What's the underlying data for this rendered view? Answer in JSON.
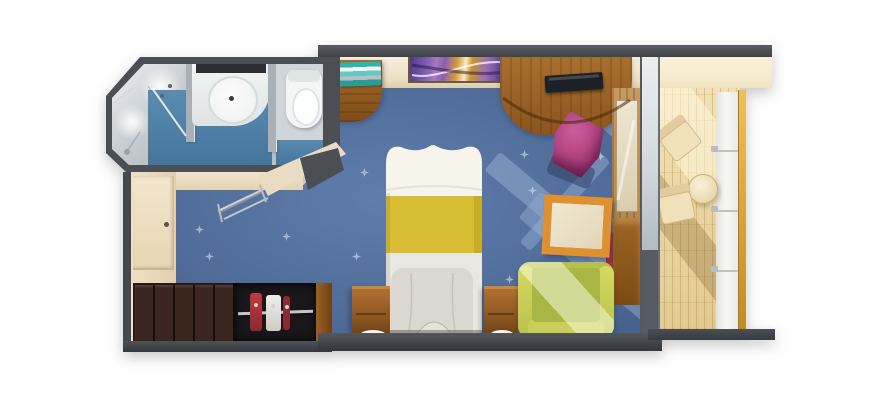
{
  "figure": {
    "type": "floorplan",
    "title": "Cruise ship balcony stateroom — top-down 3D rendered floor plan",
    "background_color": "#ffffff",
    "visible_text": []
  },
  "palette": {
    "walls": "#45494e",
    "carpet_blue": "#54719e",
    "carpet_sparkle": "#d6e1f2",
    "light_streak_blue": "#8fa9c9",
    "wall_face_beige": "#ecdfc6",
    "bathroom_floor_blue": "#4f81a9",
    "bathroom_tile_gray": "#c6ccd0",
    "fixture_white": "#f4f6f5",
    "wood_medium": "#9c6128",
    "wardrobe_dark_brown": "#3b261e",
    "bed_linen_white": "#f6f3ec",
    "bed_blanket_yellow": "#d9bd35",
    "sofa_green": "#bcc452",
    "ottoman_magenta": "#b3437f",
    "table_frame_orange": "#e0902f",
    "balcony_deck_tan": "#ecd8a4",
    "railing_white": "#f3f3f0",
    "railing_trim_gold": "#d8a33c",
    "glass_gray": "#cfd6da",
    "artwork_purple": "#7d5cb2",
    "artwork_gold": "#d99b3a"
  },
  "rooms": [
    {
      "name": "bathroom",
      "floor": "blue and gray tile",
      "features": [
        "shower",
        "vanity sink",
        "toilet",
        "glass partitions"
      ]
    },
    {
      "name": "entry corridor",
      "floor": "blue star-pattern carpet with beige entry",
      "features": [
        "entry door",
        "wardrobe",
        "open closet with hanging clothes",
        "folding luggage rack"
      ]
    },
    {
      "name": "bedroom",
      "floor": "blue star-pattern carpet",
      "features": [
        "bed",
        "two nightstands",
        "curved desk vanity with TV",
        "wall artwork",
        "book shelf",
        "magenta ottoman",
        "orange-framed coffee table",
        "green sofa",
        "mirrored closet strip"
      ]
    },
    {
      "name": "balcony",
      "floor": "teak wood planks",
      "features": [
        "two deck chairs",
        "round side table",
        "white glass railing with gold handrail",
        "sliding glass door"
      ]
    }
  ],
  "items": {
    "bed": {
      "name": "bed with yellow runner",
      "colors": [
        "#f6f3ec",
        "#d9bd35"
      ],
      "bbox": [
        381,
        138,
        106,
        202
      ]
    },
    "sofa": {
      "name": "green sofa",
      "colors": [
        "#bcc452"
      ],
      "bbox": [
        518,
        262,
        96,
        76
      ]
    },
    "ottoman": {
      "name": "magenta ottoman",
      "colors": [
        "#b3437f"
      ],
      "bbox": [
        552,
        116,
        50,
        58
      ]
    },
    "coffee_table": {
      "name": "orange-framed coffee table",
      "colors": [
        "#e0902f",
        "#ece1c8"
      ],
      "bbox": [
        543,
        196,
        68,
        60
      ]
    },
    "desk": {
      "name": "curved wood desk vanity",
      "colors": [
        "#9c6128"
      ],
      "bbox": [
        500,
        57,
        132,
        78
      ]
    },
    "tv": {
      "name": "tv on desk",
      "colors": [
        "#1d2127"
      ],
      "bbox": [
        545,
        74,
        58,
        17
      ]
    },
    "artwork": {
      "name": "abstract wall artwork",
      "colors": [
        "#7d5cb2",
        "#d99b3a"
      ],
      "bbox": [
        408,
        53,
        106,
        30
      ]
    },
    "shelf": {
      "name": "corner shelf with books",
      "colors": [
        "#9c6128",
        "#2fb3ae"
      ],
      "bbox": [
        336,
        60,
        46,
        62
      ]
    },
    "nightstand_left": {
      "name": "left nightstand",
      "bbox": [
        352,
        286,
        38,
        52
      ]
    },
    "nightstand_right": {
      "name": "right nightstand",
      "bbox": [
        484,
        286,
        34,
        52
      ]
    },
    "wardrobe": {
      "name": "dark wardrobe cabinets",
      "bbox": [
        133,
        283,
        100,
        58
      ]
    },
    "closet": {
      "name": "open closet with hanging clothes",
      "bbox": [
        233,
        283,
        85,
        58
      ]
    },
    "luggage_rack": {
      "name": "folding luggage rack",
      "bbox": [
        218,
        189,
        50,
        33
      ]
    },
    "entry_door": {
      "name": "entry door",
      "bbox": [
        133,
        176,
        41,
        92
      ]
    },
    "shower": {
      "name": "shower area",
      "bbox": [
        112,
        64,
        78,
        101
      ]
    },
    "sink": {
      "name": "round vanity sink",
      "bbox": [
        208,
        76,
        46,
        44
      ]
    },
    "toilet": {
      "name": "toilet",
      "bbox": [
        286,
        70,
        36,
        58
      ]
    },
    "glass_door": {
      "name": "balcony glass door wall",
      "bbox": [
        640,
        55,
        16,
        280
      ]
    },
    "mirror_closet": {
      "name": "mirrored closet strip",
      "bbox": [
        612,
        88,
        28,
        217
      ]
    },
    "deck_chair_upper": {
      "name": "balcony deck chair (upper)",
      "bbox": [
        658,
        116,
        42,
        46
      ]
    },
    "deck_chair_lower": {
      "name": "balcony deck chair (lower)",
      "bbox": [
        655,
        182,
        42,
        48
      ]
    },
    "balcony_table": {
      "name": "round balcony table",
      "bbox": [
        688,
        174,
        28,
        28
      ]
    },
    "railing": {
      "name": "balcony railing with gold handrail",
      "bbox": [
        711,
        90,
        34,
        244
      ]
    }
  }
}
